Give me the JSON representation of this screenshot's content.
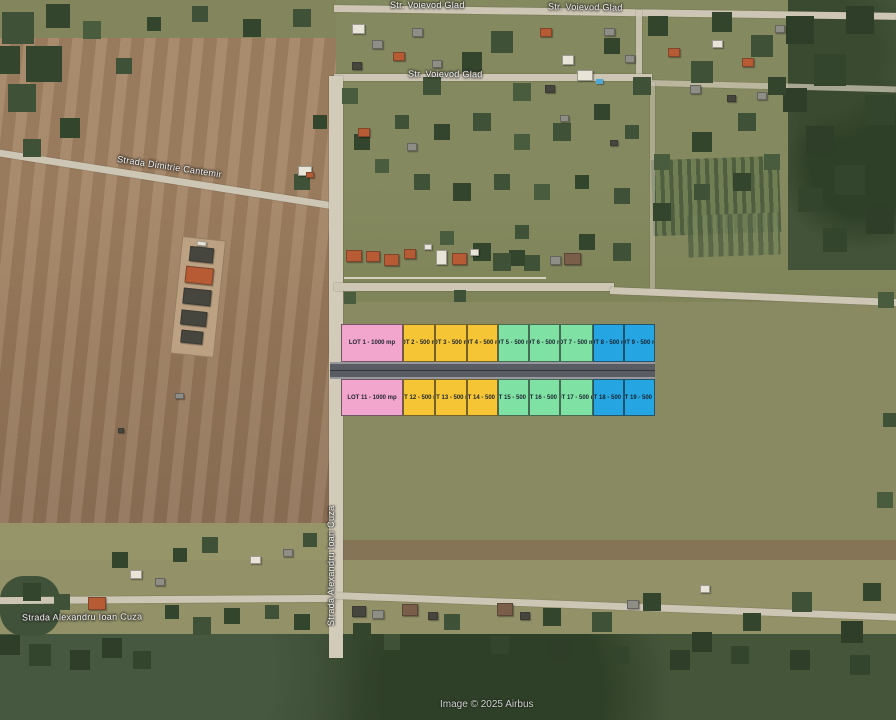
{
  "attribution": "Image © 2025 Airbus",
  "streets": {
    "voievod_glad": "Str. Voievod Glad",
    "dimitrie_cantemir": "Strada Dimitrie Cantemir",
    "alexandru_ioan_cuza": "Strada Alexandru Ioan Cuza"
  },
  "colors": {
    "pink": "#f2a6ce",
    "yellow": "#f5c535",
    "green": "#7fe2a4",
    "blue": "#25a6e2",
    "planned_road": "#5a5c64"
  },
  "lots": {
    "row1": [
      {
        "label": "LOT 1 - 1000 mp",
        "color": "pink"
      },
      {
        "label": "LOT 2 - 500 mp",
        "color": "yellow"
      },
      {
        "label": "LOT 3 - 500 mp",
        "color": "yellow"
      },
      {
        "label": "LOT 4 - 500 mp",
        "color": "yellow"
      },
      {
        "label": "LOT 5 - 500 mp",
        "color": "green"
      },
      {
        "label": "LOT 6 - 500 mp",
        "color": "green"
      },
      {
        "label": "LOT 7 - 500 mp",
        "color": "green"
      },
      {
        "label": "LOT 8 - 500 mp",
        "color": "blue"
      },
      {
        "label": "LOT 9 - 500 mp",
        "color": "blue"
      }
    ],
    "row2": [
      {
        "label": "LOT 11 - 1000 mp",
        "color": "pink"
      },
      {
        "label": "LOT 12 - 500 mp",
        "color": "yellow"
      },
      {
        "label": "LOT 13 - 500 mp",
        "color": "yellow"
      },
      {
        "label": "LOT 14 - 500 mp",
        "color": "yellow"
      },
      {
        "label": "LOT 15 - 500 mp",
        "color": "green"
      },
      {
        "label": "LOT 16 - 500 mp",
        "color": "green"
      },
      {
        "label": "LOT 17 - 500 mp",
        "color": "green"
      },
      {
        "label": "LOT 18 - 500 mp",
        "color": "blue"
      },
      {
        "label": "LOT 19 - 500 mp",
        "color": "blue"
      }
    ]
  }
}
